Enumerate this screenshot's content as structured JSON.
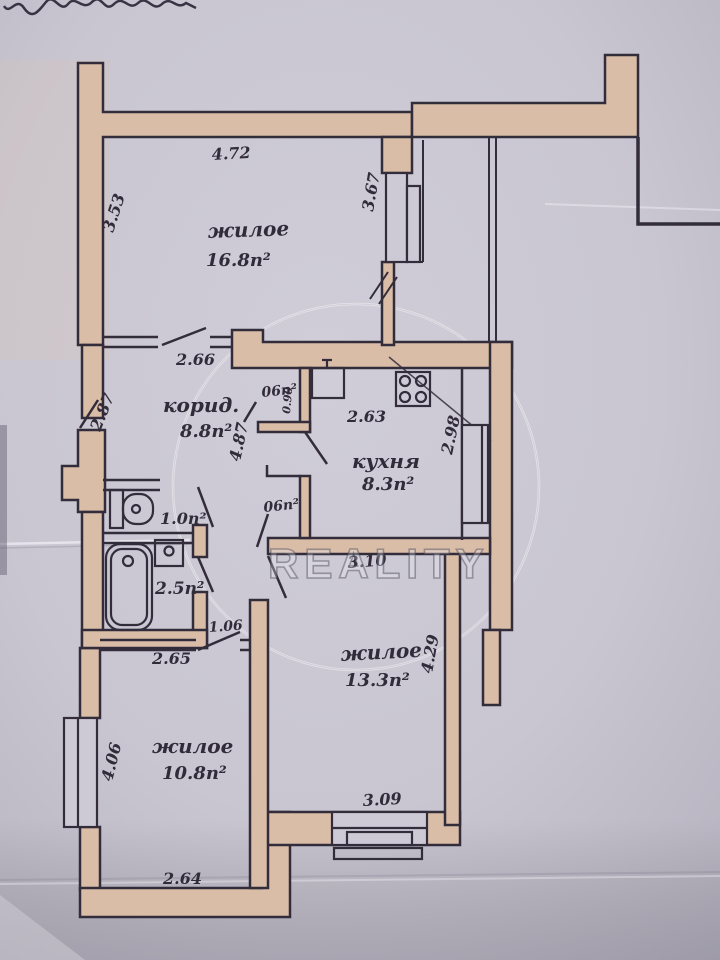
{
  "document": {
    "kind": "scanned apartment floor plan",
    "language": "ru",
    "watermark_text": "REALITY"
  },
  "rooms": {
    "living_top": {
      "name": "жилое",
      "area": "16.8п²"
    },
    "corridor": {
      "name": "корид.",
      "area": "8.8п²"
    },
    "kitchen": {
      "name": "кухня",
      "area": "8.3п²"
    },
    "wc": {
      "area": "1.0п²"
    },
    "bathroom": {
      "area": "2.5п²"
    },
    "closet_top": {
      "area": "06п²"
    },
    "closet_bottom": {
      "area": "06п²"
    },
    "living_right": {
      "name": "жилое",
      "area": "13.3п²"
    },
    "living_bottom": {
      "name": "жилое",
      "area": "10.8п²"
    }
  },
  "dimensions": {
    "living_top_width": "4.72",
    "living_top_depth": "3.53",
    "niche_depth": "3.67",
    "corridor_width": "2.66",
    "entry_wall": "2.87",
    "kitchen_width": "2.63",
    "corridor_depth": "4.87",
    "closet_width": "0.90",
    "kitchen_depth": "2.98",
    "kitchen_bottom_width": "3.10",
    "living_right_depth": "4.29",
    "hall_width": "1.06",
    "living_bottom_top_width": "2.65",
    "living_bottom_depth": "4.06",
    "living_right_bottom_width": "3.09",
    "living_bottom_width": "2.64"
  },
  "colors": {
    "paper": "#c9c6d1",
    "wall_fill": "#d9bda7",
    "ink": "#332c3b"
  }
}
